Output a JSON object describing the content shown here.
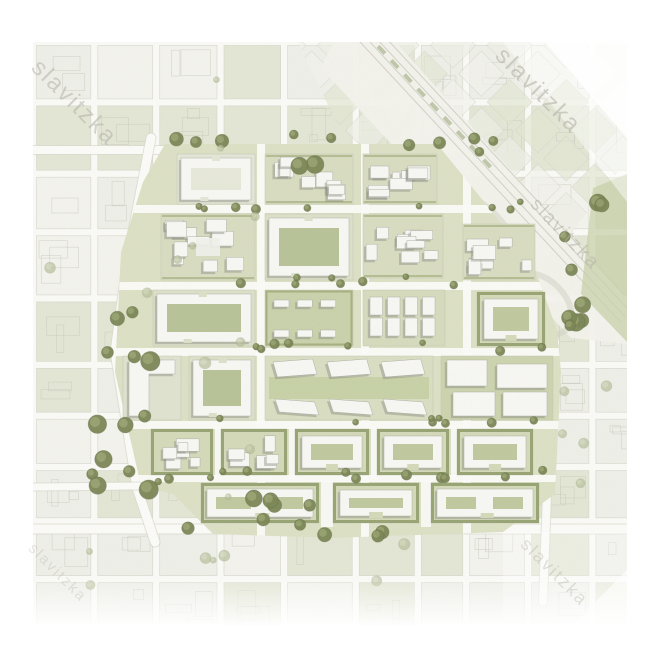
{
  "meta": {
    "kind": "urban-masterplan-aerial-rendering",
    "canvas": {
      "w": 670,
      "h": 670
    }
  },
  "map": {
    "x": 33,
    "y": 42,
    "w": 594,
    "h": 583,
    "seed": 11
  },
  "palette": {
    "page_bg": "#ffffff",
    "map_bg": "#fafaf6",
    "street": "#fbfbf8",
    "road_casing": "#d8d9cd",
    "context_green": "#e2e5d2",
    "context_light": "#eeefe7",
    "context_pale": "#f3f3ed",
    "context_outline": "#d2d3c7",
    "parcel_line": "#c6c7ba",
    "plan_ground": "#dce0c4",
    "court_green": "#b8c297",
    "court_pale": "#e6e8d8",
    "plaza_green": "#c6cfa4",
    "hedge": "#8a9663",
    "hedge_light": "#97a26b",
    "building": "#f7f7f3",
    "building_line": "#aeb0a5",
    "shadow": "#84867b",
    "tree_dark": "#7b8655",
    "tree_mid": "#99a471",
    "tree_rim": "#5c663f",
    "tree_light": "#b7bf9b",
    "tree_light2": "#cdd3b4",
    "tree_light_rim": "#9aa37f",
    "corridor": "#f3f2ec",
    "corridor_line": "#ccccc2",
    "median_green": "#aeb893",
    "strip_green": "#c8d0a9",
    "watermark": "#b0ada3"
  },
  "watermarks": [
    {
      "text": "slavitzka",
      "x": 12,
      "y": 12,
      "size": 24,
      "rot": 45,
      "opacity": 0.5
    },
    {
      "text": "slavitzka",
      "x": 476,
      "y": 0,
      "size": 24,
      "rot": 45,
      "opacity": 0.55
    },
    {
      "text": "slavitzka",
      "x": 508,
      "y": 152,
      "size": 19,
      "rot": 46,
      "opacity": 0.5
    },
    {
      "text": "slavitzka",
      "x": 4,
      "y": 498,
      "size": 15,
      "rot": 45,
      "opacity": 0.3
    },
    {
      "text": "slavitzka",
      "x": 498,
      "y": 492,
      "size": 18,
      "rot": 45,
      "opacity": 0.35
    }
  ],
  "context": {
    "cell_min": 46,
    "cell_var": 30,
    "street": 7
  },
  "diag_grid": {
    "cell": 40,
    "block": 32,
    "opacity": 0.8,
    "clip": "265,0 594,0 594,118 498,244 412,258 302,78",
    "cx": 420,
    "cy": 60
  },
  "corridor": {
    "band": "306,-12 352,-12 594,258 594,302 538,296 288,26",
    "x1": 330,
    "y1": -12,
    "x2": 594,
    "y2": 272,
    "line_offsets": [
      -10,
      -3,
      4,
      11
    ],
    "ramps": [
      {
        "cx": 438,
        "cy": 196,
        "rx": 54,
        "ry": 34
      },
      {
        "cx": 508,
        "cy": 262,
        "rx": 36,
        "ry": 24
      }
    ]
  },
  "green_strip": "560,146 594,132 594,300 548,252",
  "major_roads": [
    {
      "pts": "0,108 440,108",
      "w": 8
    },
    {
      "pts": "0,487 594,487",
      "w": 9
    },
    {
      "pts": "118,96 95,215 82,310 104,446 122,500",
      "w": 9
    },
    {
      "pts": "500,230 522,300 518,370 514,452 510,560",
      "w": 8
    },
    {
      "pts": "0,445 108,444",
      "w": 7
    }
  ],
  "plan": {
    "area": "132,102 404,102 448,156 500,222 524,288 528,330 522,452 470,490 300,496 180,492 140,452 108,444 82,330 88,210 110,140",
    "h_streets": [
      [
        163,
        8
      ],
      [
        240,
        8
      ],
      [
        306,
        8
      ],
      [
        379,
        8
      ],
      [
        433,
        7
      ]
    ],
    "v_streets": [
      [
        224,
        8
      ],
      [
        328,
        8
      ],
      [
        430,
        8
      ]
    ],
    "v_segments": [
      [
        182,
        385,
        6,
        52
      ],
      [
        256,
        385,
        6,
        52
      ],
      [
        338,
        385,
        6,
        52
      ],
      [
        418,
        385,
        6,
        52
      ],
      [
        288,
        439,
        12,
        46
      ],
      [
        388,
        439,
        10,
        46
      ]
    ],
    "blocks": [
      {
        "x": 144,
        "y": 112,
        "w": 78,
        "h": 50,
        "kind": "ring"
      },
      {
        "x": 232,
        "y": 112,
        "w": 88,
        "h": 50,
        "kind": "dense"
      },
      {
        "x": 330,
        "y": 112,
        "w": 74,
        "h": 50,
        "kind": "dense"
      },
      {
        "x": 128,
        "y": 172,
        "w": 94,
        "h": 66,
        "kind": "dense-plaza"
      },
      {
        "x": 232,
        "y": 172,
        "w": 88,
        "h": 66,
        "kind": "ring-green"
      },
      {
        "x": 330,
        "y": 172,
        "w": 80,
        "h": 64,
        "kind": "dense"
      },
      {
        "x": 430,
        "y": 182,
        "w": 72,
        "h": 56,
        "kind": "dense"
      },
      {
        "x": 120,
        "y": 248,
        "w": 102,
        "h": 56,
        "kind": "ring-green"
      },
      {
        "x": 232,
        "y": 248,
        "w": 88,
        "h": 56,
        "kind": "park-slabs"
      },
      {
        "x": 330,
        "y": 248,
        "w": 82,
        "h": 56,
        "kind": "towers"
      },
      {
        "x": 444,
        "y": 250,
        "w": 68,
        "h": 54,
        "kind": "hedge-court"
      },
      {
        "x": 90,
        "y": 314,
        "w": 58,
        "h": 64,
        "kind": "l-slab"
      },
      {
        "x": 156,
        "y": 314,
        "w": 66,
        "h": 64,
        "kind": "ring-green"
      },
      {
        "x": 232,
        "y": 314,
        "w": 168,
        "h": 64,
        "kind": "civic"
      },
      {
        "x": 408,
        "y": 314,
        "w": 112,
        "h": 64,
        "kind": "big-slabs"
      },
      {
        "x": 118,
        "y": 387,
        "w": 62,
        "h": 46,
        "kind": "hedge-dense"
      },
      {
        "x": 188,
        "y": 387,
        "w": 66,
        "h": 46,
        "kind": "hedge-dense"
      },
      {
        "x": 262,
        "y": 387,
        "w": 74,
        "h": 46,
        "kind": "hedge-court"
      },
      {
        "x": 344,
        "y": 387,
        "w": 72,
        "h": 46,
        "kind": "hedge-court"
      },
      {
        "x": 424,
        "y": 387,
        "w": 76,
        "h": 46,
        "kind": "hedge-court"
      },
      {
        "x": 168,
        "y": 441,
        "w": 118,
        "h": 40,
        "kind": "hedge-court-wide"
      },
      {
        "x": 300,
        "y": 441,
        "w": 86,
        "h": 40,
        "kind": "hedge-court"
      },
      {
        "x": 398,
        "y": 441,
        "w": 108,
        "h": 40,
        "kind": "hedge-court-wide"
      }
    ]
  },
  "tree_clusters": [
    {
      "x": 58,
      "y": 255,
      "w": 62,
      "h": 195,
      "n": 13,
      "r0": 5,
      "r1": 10,
      "tone": "dark"
    },
    {
      "x": 128,
      "y": 92,
      "w": 290,
      "h": 16,
      "n": 7,
      "r0": 4,
      "r1": 7,
      "tone": "dark"
    },
    {
      "x": 258,
      "y": 108,
      "w": 26,
      "h": 16,
      "n": 2,
      "r0": 7,
      "r1": 9,
      "tone": "dark"
    },
    {
      "x": 112,
      "y": 158,
      "w": 400,
      "h": 10,
      "n": 9,
      "r0": 3,
      "r1": 5,
      "tone": "dark"
    },
    {
      "x": 112,
      "y": 234,
      "w": 400,
      "h": 10,
      "n": 8,
      "r0": 3,
      "r1": 5,
      "tone": "dark"
    },
    {
      "x": 112,
      "y": 300,
      "w": 400,
      "h": 10,
      "n": 8,
      "r0": 3,
      "r1": 5,
      "tone": "dark"
    },
    {
      "x": 112,
      "y": 374,
      "w": 400,
      "h": 10,
      "n": 8,
      "r0": 3,
      "r1": 5,
      "tone": "dark"
    },
    {
      "x": 112,
      "y": 428,
      "w": 400,
      "h": 12,
      "n": 12,
      "r0": 3,
      "r1": 6,
      "tone": "dark"
    },
    {
      "x": 150,
      "y": 452,
      "w": 210,
      "h": 42,
      "n": 10,
      "r0": 5,
      "r1": 9,
      "tone": "dark"
    },
    {
      "x": 530,
      "y": 155,
      "w": 40,
      "h": 135,
      "n": 9,
      "r0": 5,
      "r1": 9,
      "tone": "dark"
    },
    {
      "x": 436,
      "y": 96,
      "w": 60,
      "h": 40,
      "n": 3,
      "r0": 4,
      "r1": 6,
      "tone": "dark"
    },
    {
      "x": 10,
      "y": 10,
      "w": 220,
      "h": 420,
      "n": 10,
      "r0": 3,
      "r1": 6,
      "tone": "light"
    },
    {
      "x": 20,
      "y": 440,
      "w": 540,
      "h": 110,
      "n": 8,
      "r0": 3,
      "r1": 6,
      "tone": "light"
    },
    {
      "x": 470,
      "y": 330,
      "w": 110,
      "h": 120,
      "n": 5,
      "r0": 4,
      "r1": 7,
      "tone": "light"
    }
  ]
}
